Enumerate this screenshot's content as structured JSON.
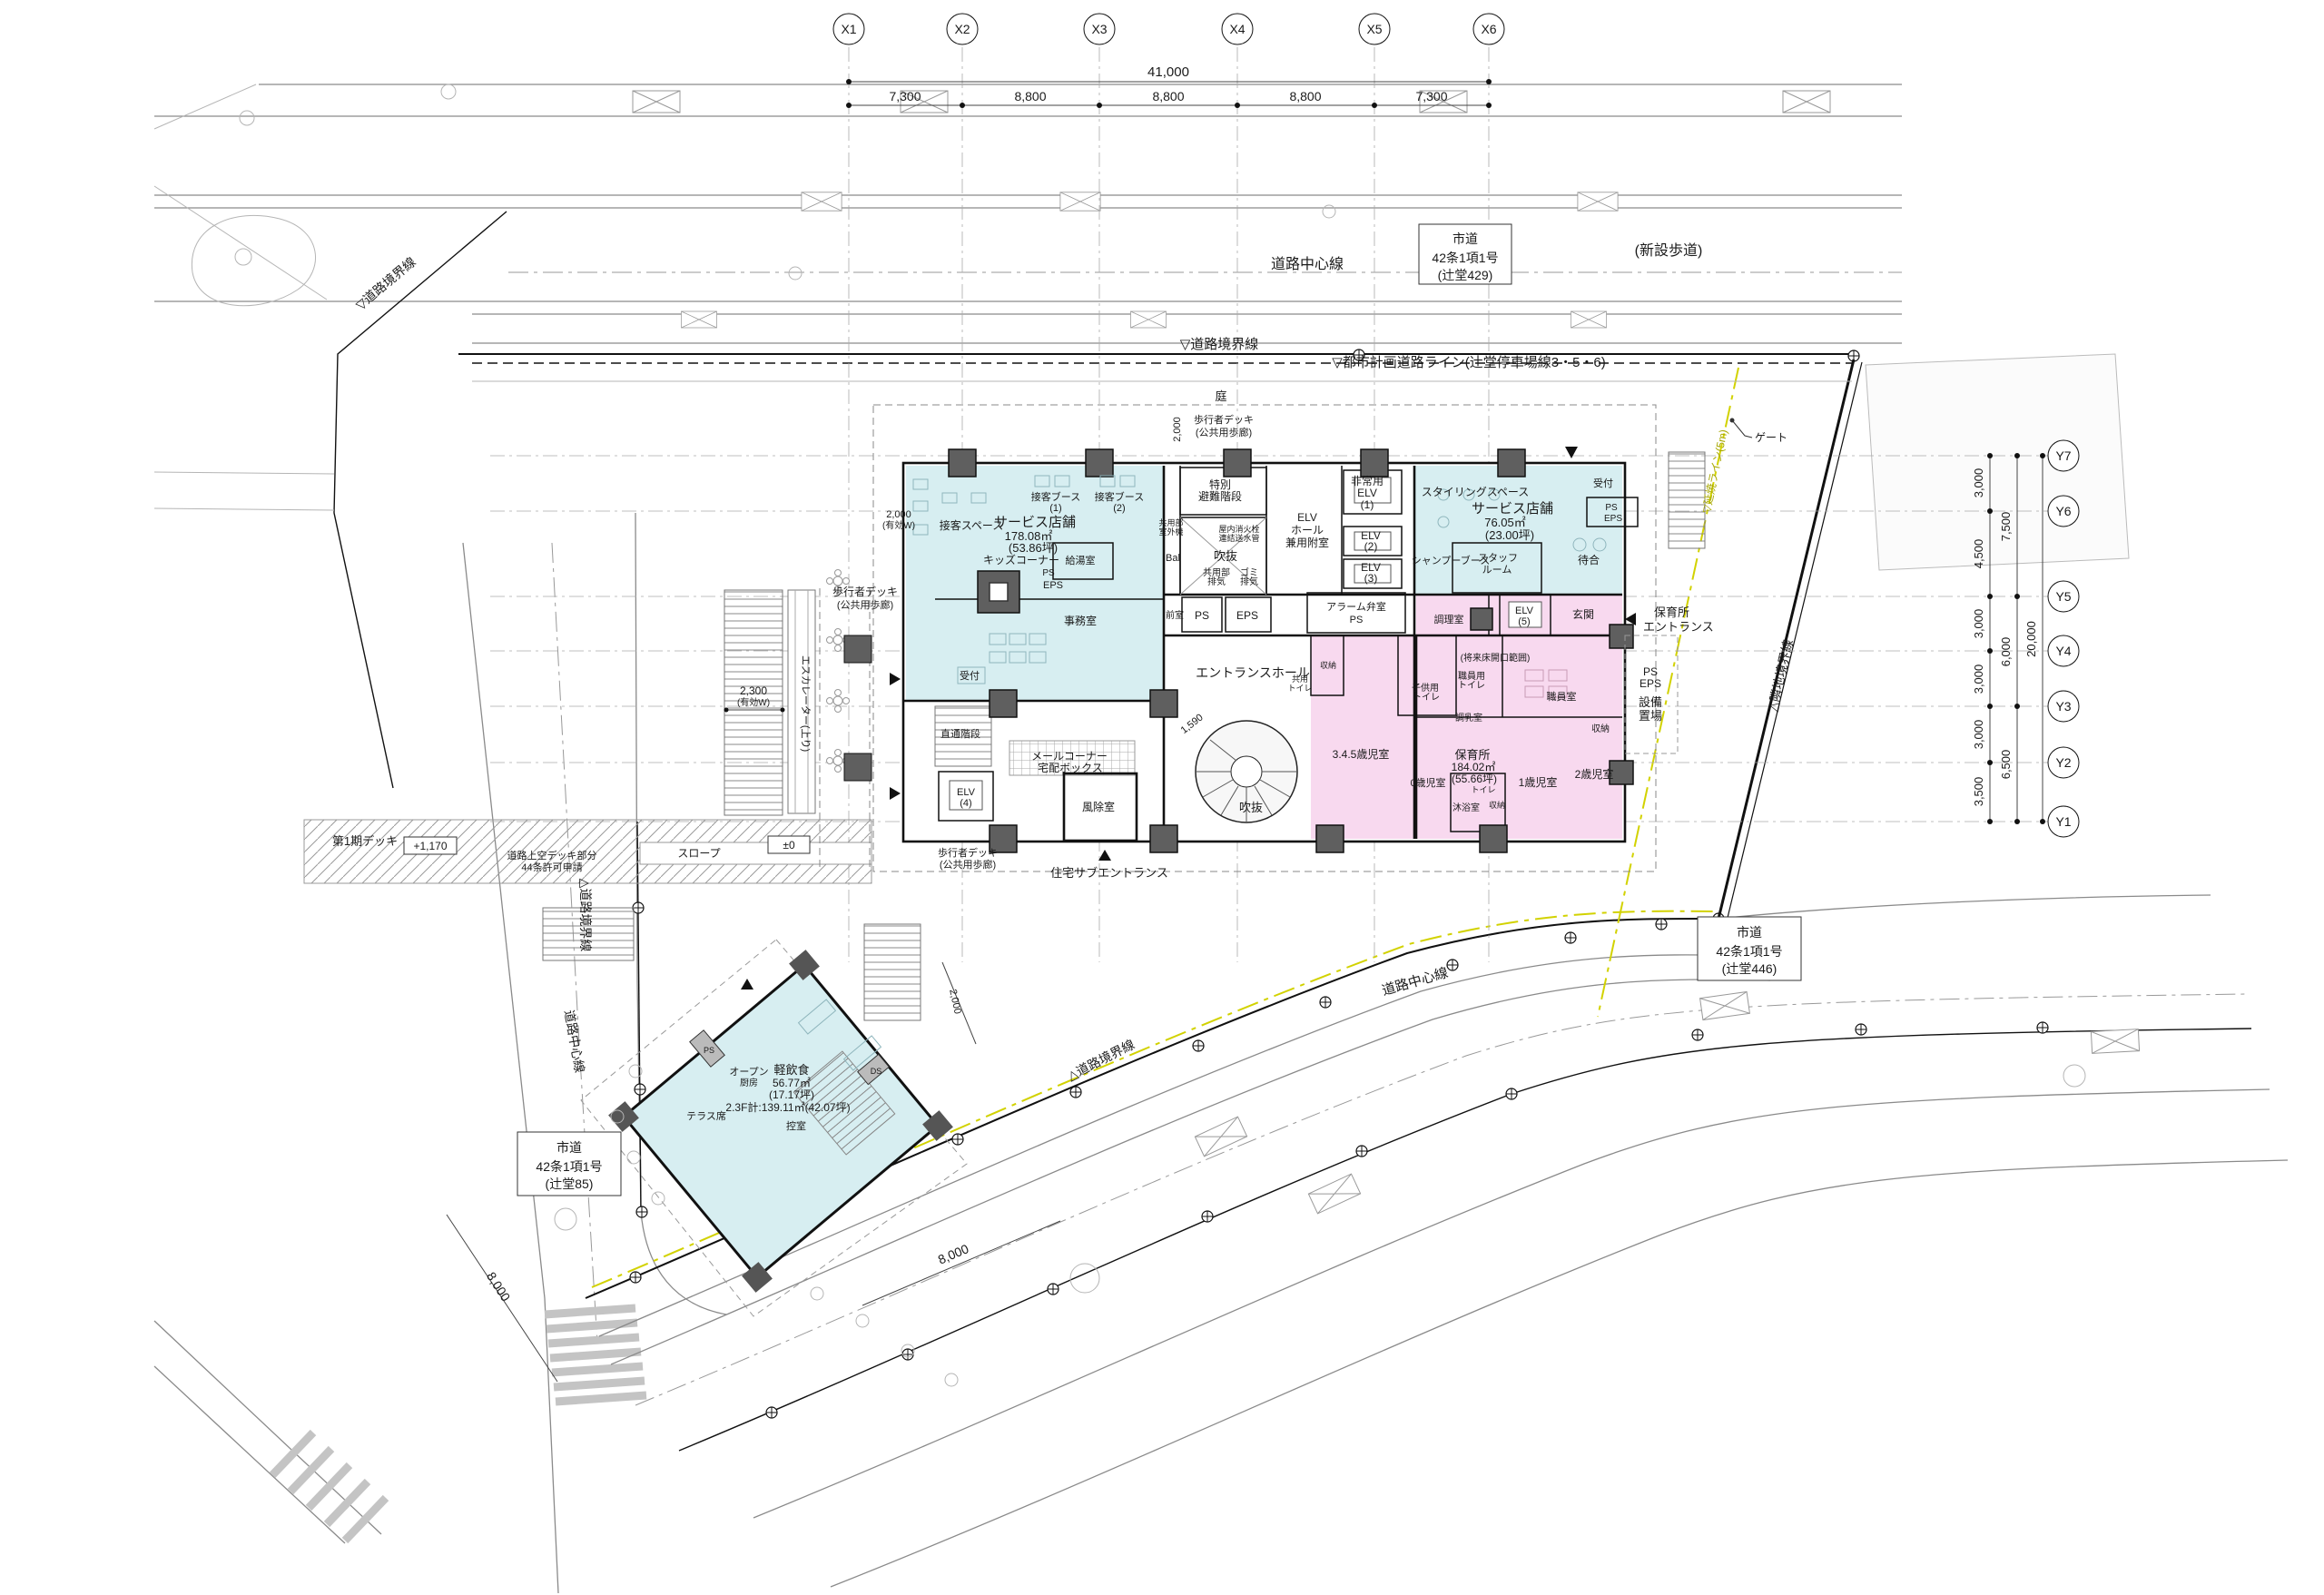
{
  "axes": {
    "x": {
      "labels": [
        "X1",
        "X2",
        "X3",
        "X4",
        "X5",
        "X6"
      ],
      "total": "41,000",
      "segments": [
        "7,300",
        "8,800",
        "8,800",
        "8,800",
        "7,300"
      ]
    },
    "y": {
      "labels": [
        "Y7",
        "Y6",
        "Y5",
        "Y4",
        "Y3",
        "Y2",
        "Y1"
      ],
      "total": "20,000",
      "segments": [
        "3,000",
        "4,500",
        "3,000",
        "3,000",
        "3,000",
        "3,500"
      ],
      "groups": [
        "7,500",
        "6,000",
        "6,500"
      ]
    }
  },
  "roads": {
    "center_line": "道路中心線",
    "boundary_down": "▽道路境界線",
    "boundary_up": "△道路境界線",
    "city_planning": "▽都市計画道路ライン(辻堂停車場線3・5・6)",
    "new_sidewalk": "(新設歩道)",
    "route429": [
      "市道",
      "42条1項1号",
      "(辻堂429)"
    ],
    "route85": [
      "市道",
      "42条1項1号",
      "(辻堂85)"
    ],
    "route446": [
      "市道",
      "42条1項1号",
      "(辻堂446)"
    ],
    "adjacent_boundary": "△隣地境界線",
    "fire_line": "▽延焼ライン(5m)",
    "gate": "ゲート",
    "dim_8000": "8,000"
  },
  "site": {
    "garden": "庭",
    "deck": [
      "歩行者デッキ",
      "(公共用歩廊)"
    ],
    "dim2000": "2,000",
    "dim2000w": [
      "2,000",
      "(有効W)"
    ],
    "dim2300w": [
      "2,300",
      "(有効W)"
    ],
    "escalator": "エスカレーター(上り)",
    "phase1_deck": "第1期デッキ",
    "lv1170": "+1,170",
    "lv0": "±0",
    "slope": "スロープ",
    "over_road": [
      "道路上空デッキ部分",
      "44条許可申請"
    ],
    "nursery_ent": [
      "保育所",
      "エントランス"
    ],
    "equip": [
      "設備",
      "置場"
    ],
    "ps": "PS",
    "eps": "EPS",
    "dim1590": "1,590"
  },
  "shop1": {
    "booth1": [
      "接客ブース",
      "(1)"
    ],
    "booth2": [
      "接客ブース",
      "(2)"
    ],
    "space": "接客スペース",
    "name": "サービス店舗",
    "area": "178.08㎡",
    "tsubo": "(53.86坪)",
    "kids": "キッズコーナー",
    "kyuto": "給湯室",
    "ps": "PS",
    "eps": "EPS",
    "office": "事務室",
    "reception": "受付"
  },
  "core": {
    "stair": [
      "特別",
      "避難階段"
    ],
    "elv1": [
      "非常用",
      "ELV",
      "(1)"
    ],
    "hall": [
      "ELV",
      "ホール",
      "兼用附室"
    ],
    "elv2": [
      "ELV",
      "(2)"
    ],
    "elv3": [
      "ELV",
      "(3)"
    ],
    "void": "吹抜",
    "hydrant": [
      "屋内消火栓",
      "連結送水管"
    ],
    "kyoyo_exh": [
      "共用部",
      "排気"
    ],
    "gomi_exh": [
      "ゴミ",
      "排気"
    ],
    "bal": "Bal",
    "outdoor": [
      "共用部",
      "室外機"
    ],
    "anteroom": "前室",
    "ps": "PS",
    "eps": "EPS",
    "alarm": [
      "アラーム弁室",
      "PS"
    ],
    "direct_stair": "直通階段"
  },
  "shop2": {
    "styling": "スタイリングスペース",
    "name": "サービス店舗",
    "area": "76.05㎡",
    "tsubo": "(23.00坪)",
    "reception": "受付",
    "ps": "PS",
    "eps": "EPS",
    "shampoo": "シャンプーブース",
    "staff": [
      "スタッフ",
      "ルーム"
    ],
    "wait": "待合"
  },
  "hall": {
    "name": "エントランスホール",
    "void": "吹抜",
    "mail": [
      "メールコーナー",
      "宅配ボックス"
    ],
    "windbreak": "風除室",
    "elv4": [
      "ELV",
      "(4)"
    ],
    "sub_ent": "住宅サブエントランス"
  },
  "nursery": {
    "kitchen": "調理室",
    "elv5": [
      "ELV",
      "(5)"
    ],
    "genkan": "玄関",
    "future": "(将来床開口範囲)",
    "staff_wc": [
      "職員用",
      "トイレ"
    ],
    "staff_room": "職員室",
    "milk": "調乳室",
    "storage": "収納",
    "name": "保育所",
    "area": "184.02㎡",
    "tsubo": "(55.66坪)",
    "wc": "トイレ",
    "bath": "沐浴室",
    "r1": "1歳児室",
    "r2": "2歳児室",
    "kids_wc": [
      "子供用",
      "トイレ"
    ],
    "r345": "3.4.5歳児室",
    "r0": "0歳児室",
    "shared_wc": [
      "共用",
      "トイレ"
    ]
  },
  "annex": {
    "open_kitchen": [
      "オープン",
      "厨房"
    ],
    "name": "軽飲食",
    "area": "56.77㎡",
    "tsubo": "(17.17坪)",
    "total": "2.3F計:139.11㎡(42.07坪)",
    "back": "控室",
    "terrace": "テラス席",
    "ps": "PS",
    "ds": "DS",
    "dim2000": "2,000"
  },
  "colors": {
    "shop_fill": "#d7eef1",
    "nursery_fill": "#f8d9ef",
    "fire_line": "#d2d200"
  }
}
